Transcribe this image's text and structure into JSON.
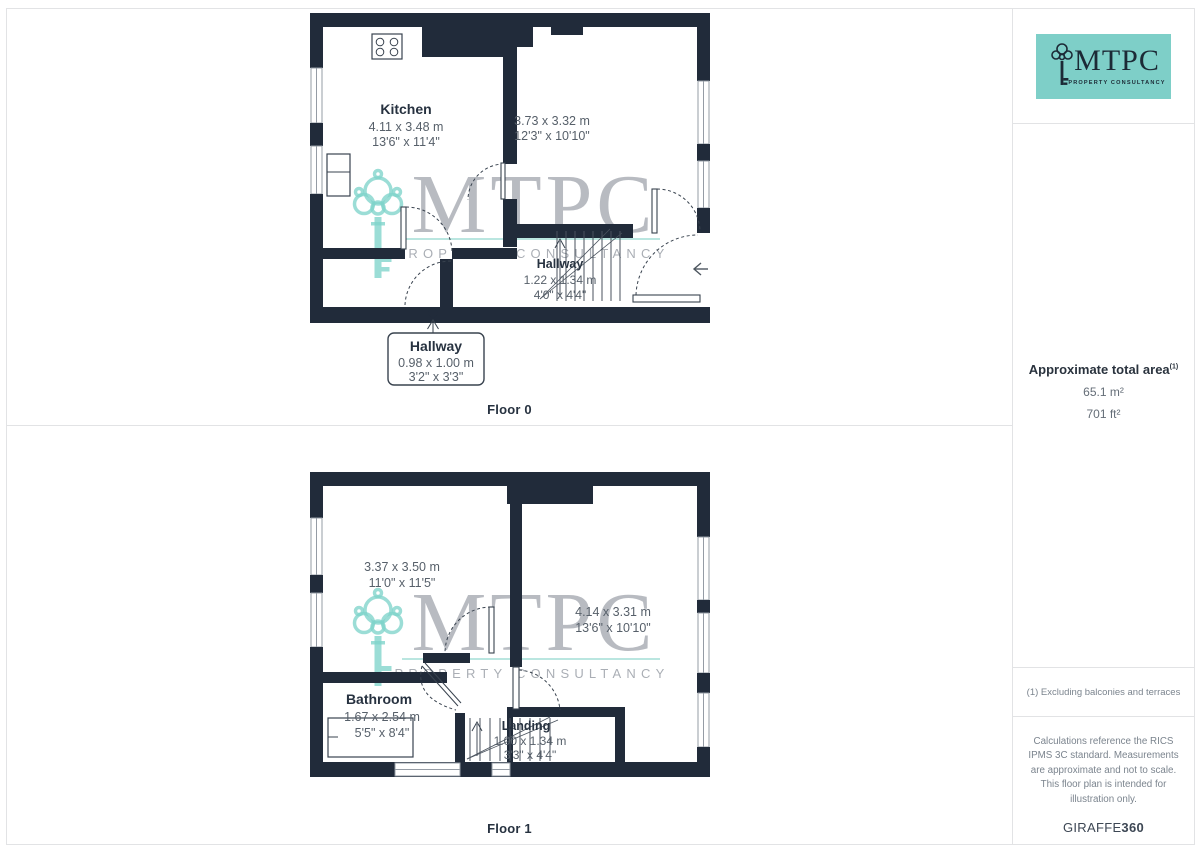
{
  "brand": {
    "name": "MTPC",
    "tagline": "PROPERTY CONSULTANCY"
  },
  "watermark": {
    "name": "MTPC",
    "tagline": "PROPERTY CONSULTANCY"
  },
  "floors": [
    {
      "label": "Floor 0",
      "rooms": [
        {
          "name": "Kitchen",
          "metric": "4.11 x 3.48 m",
          "imperial": "13'6\" x 11'4\""
        },
        {
          "name": "",
          "metric": "3.73 x 3.32 m",
          "imperial": "12'3\" x 10'10\""
        },
        {
          "name": "Hallway",
          "metric": "1.22 x 1.34 m",
          "imperial": "4'0\" x 4'4\""
        }
      ],
      "callout": {
        "name": "Hallway",
        "metric": "0.98 x 1.00 m",
        "imperial": "3'2\" x 3'3\""
      }
    },
    {
      "label": "Floor 1",
      "rooms": [
        {
          "name": "",
          "metric": "3.37 x 3.50 m",
          "imperial": "11'0\" x 11'5\""
        },
        {
          "name": "",
          "metric": "4.14 x 3.31 m",
          "imperial": "13'6\" x 10'10\""
        },
        {
          "name": "Bathroom",
          "metric": "1.67 x 2.54 m",
          "imperial": "5'5\" x 8'4\""
        },
        {
          "name": "Landing",
          "metric": "1.00 x 1.34 m",
          "imperial": "3'3\" x 4'4\""
        }
      ]
    }
  ],
  "sidebar": {
    "area_title": "Approximate total area",
    "area_footnote_marker": "(1)",
    "area_metric": "65.1 m²",
    "area_imperial": "701 ft²",
    "footnote": "(1) Excluding balconies and terraces",
    "disclaimer": "Calculations reference the RICS IPMS 3C standard. Measurements are approximate and not to scale. This floor plan is intended for illustration only.",
    "generator": "GIRAFFE",
    "generator_suffix": "360"
  },
  "icons": {
    "key": "key-icon",
    "entrance_arrow": "entrance-arrow-icon",
    "stove": "stove-icon",
    "bathtub": "bathtub-icon",
    "stairs": "stairs-icon"
  },
  "colors": {
    "wall": "#212b3a",
    "brand_teal": "#7ecfc8",
    "brand_navy": "#1c2a36",
    "watermark_gray": "#a7abb2"
  }
}
